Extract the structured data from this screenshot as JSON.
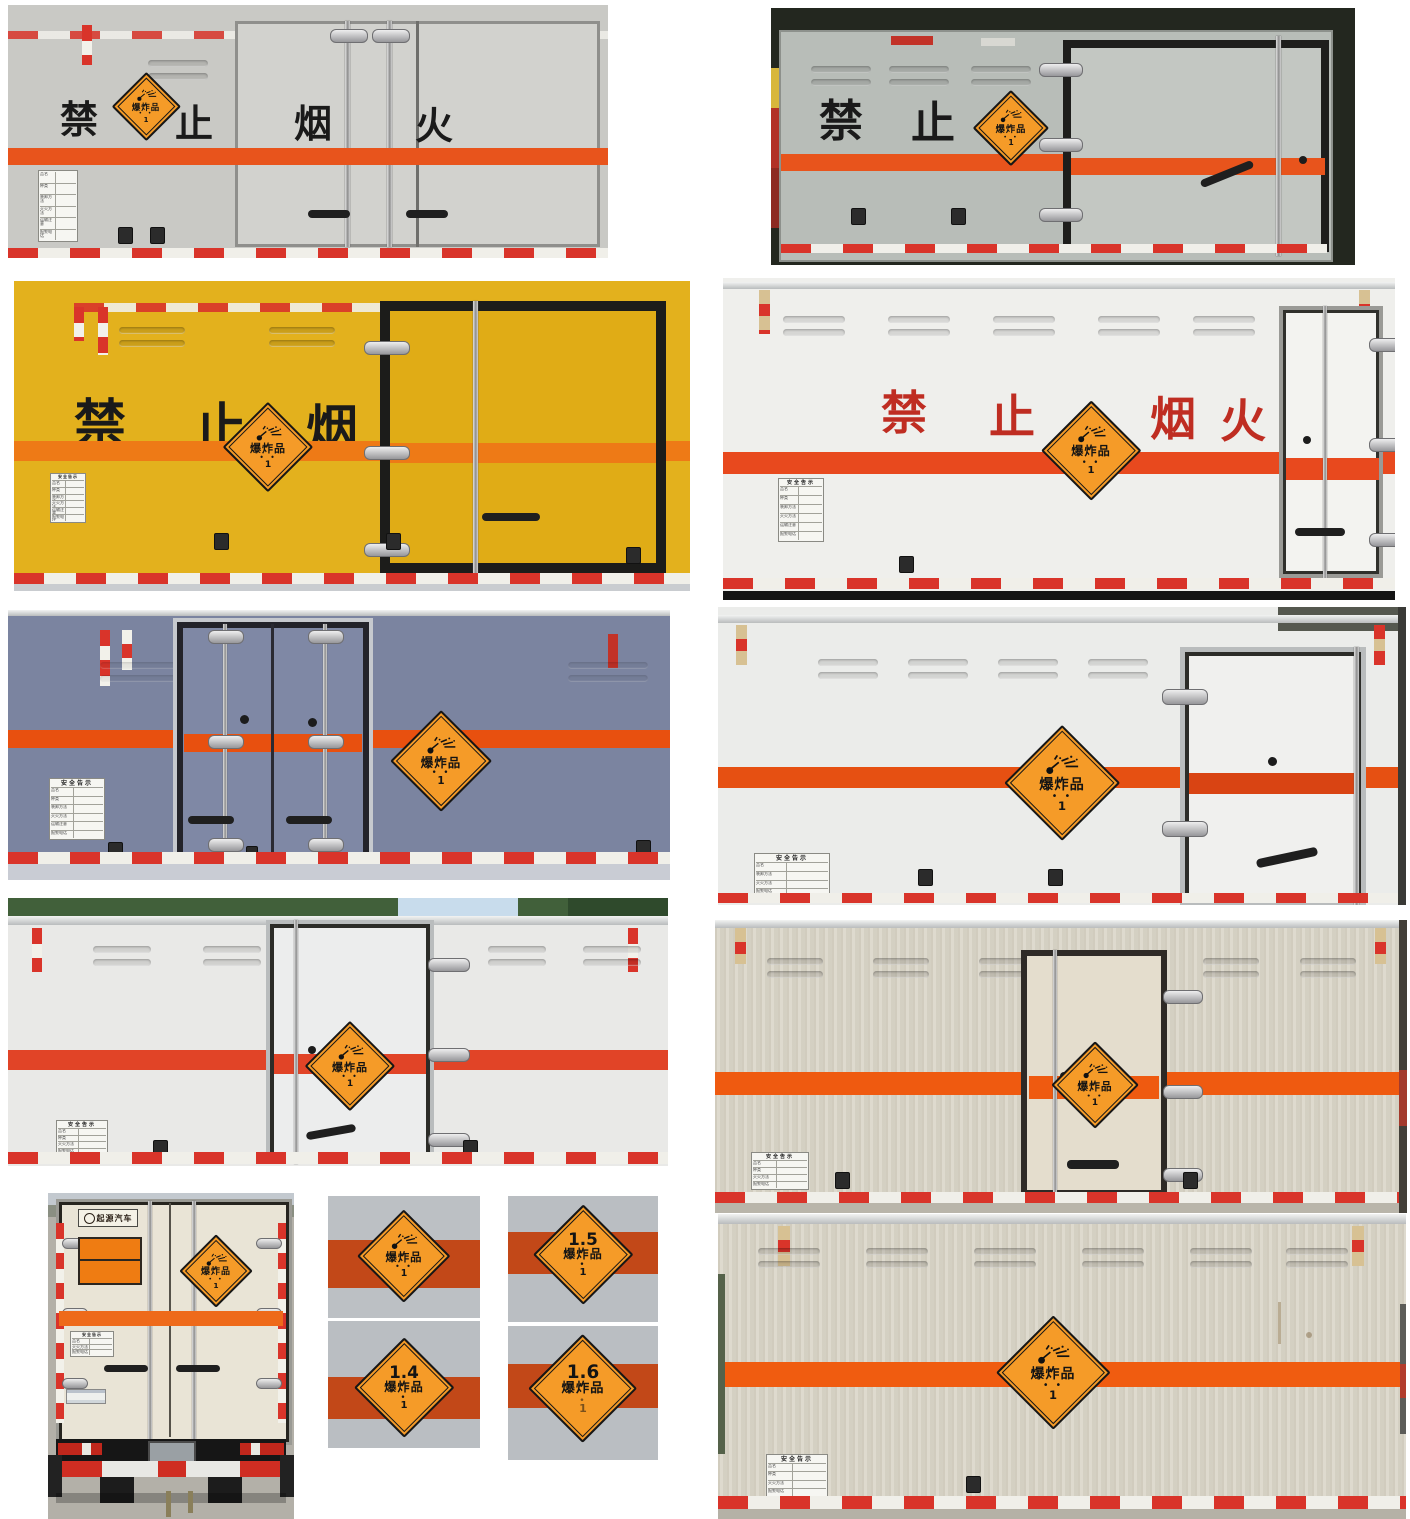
{
  "labels": {
    "no_fire_chars": [
      "禁",
      "止",
      "烟",
      "火"
    ],
    "explosive": "爆炸品",
    "class_number": "1",
    "stars": "• •",
    "dot": "•",
    "safety_header": "安全告示",
    "safety_rows": [
      "品名",
      "种类",
      "装卸方法",
      "灭火方法",
      "运输注意",
      "报警电话"
    ],
    "brand": "起源汽车",
    "subclass": {
      "s15": "1.5",
      "s14": "1.4",
      "s16": "1.6"
    }
  },
  "icons": {
    "explosion": "explosion-burst-icon"
  },
  "colors": {
    "stripe_orange": "#E8541C",
    "stripe_red": "#E14427",
    "stripe_dark": "#C24818",
    "placard_orange": "#F59B28",
    "truck_yellow": "#E3B11D",
    "truck_slate": "#7B84A0",
    "banner_black": "#1A1A1A",
    "banner_red": "#BF2D22"
  }
}
